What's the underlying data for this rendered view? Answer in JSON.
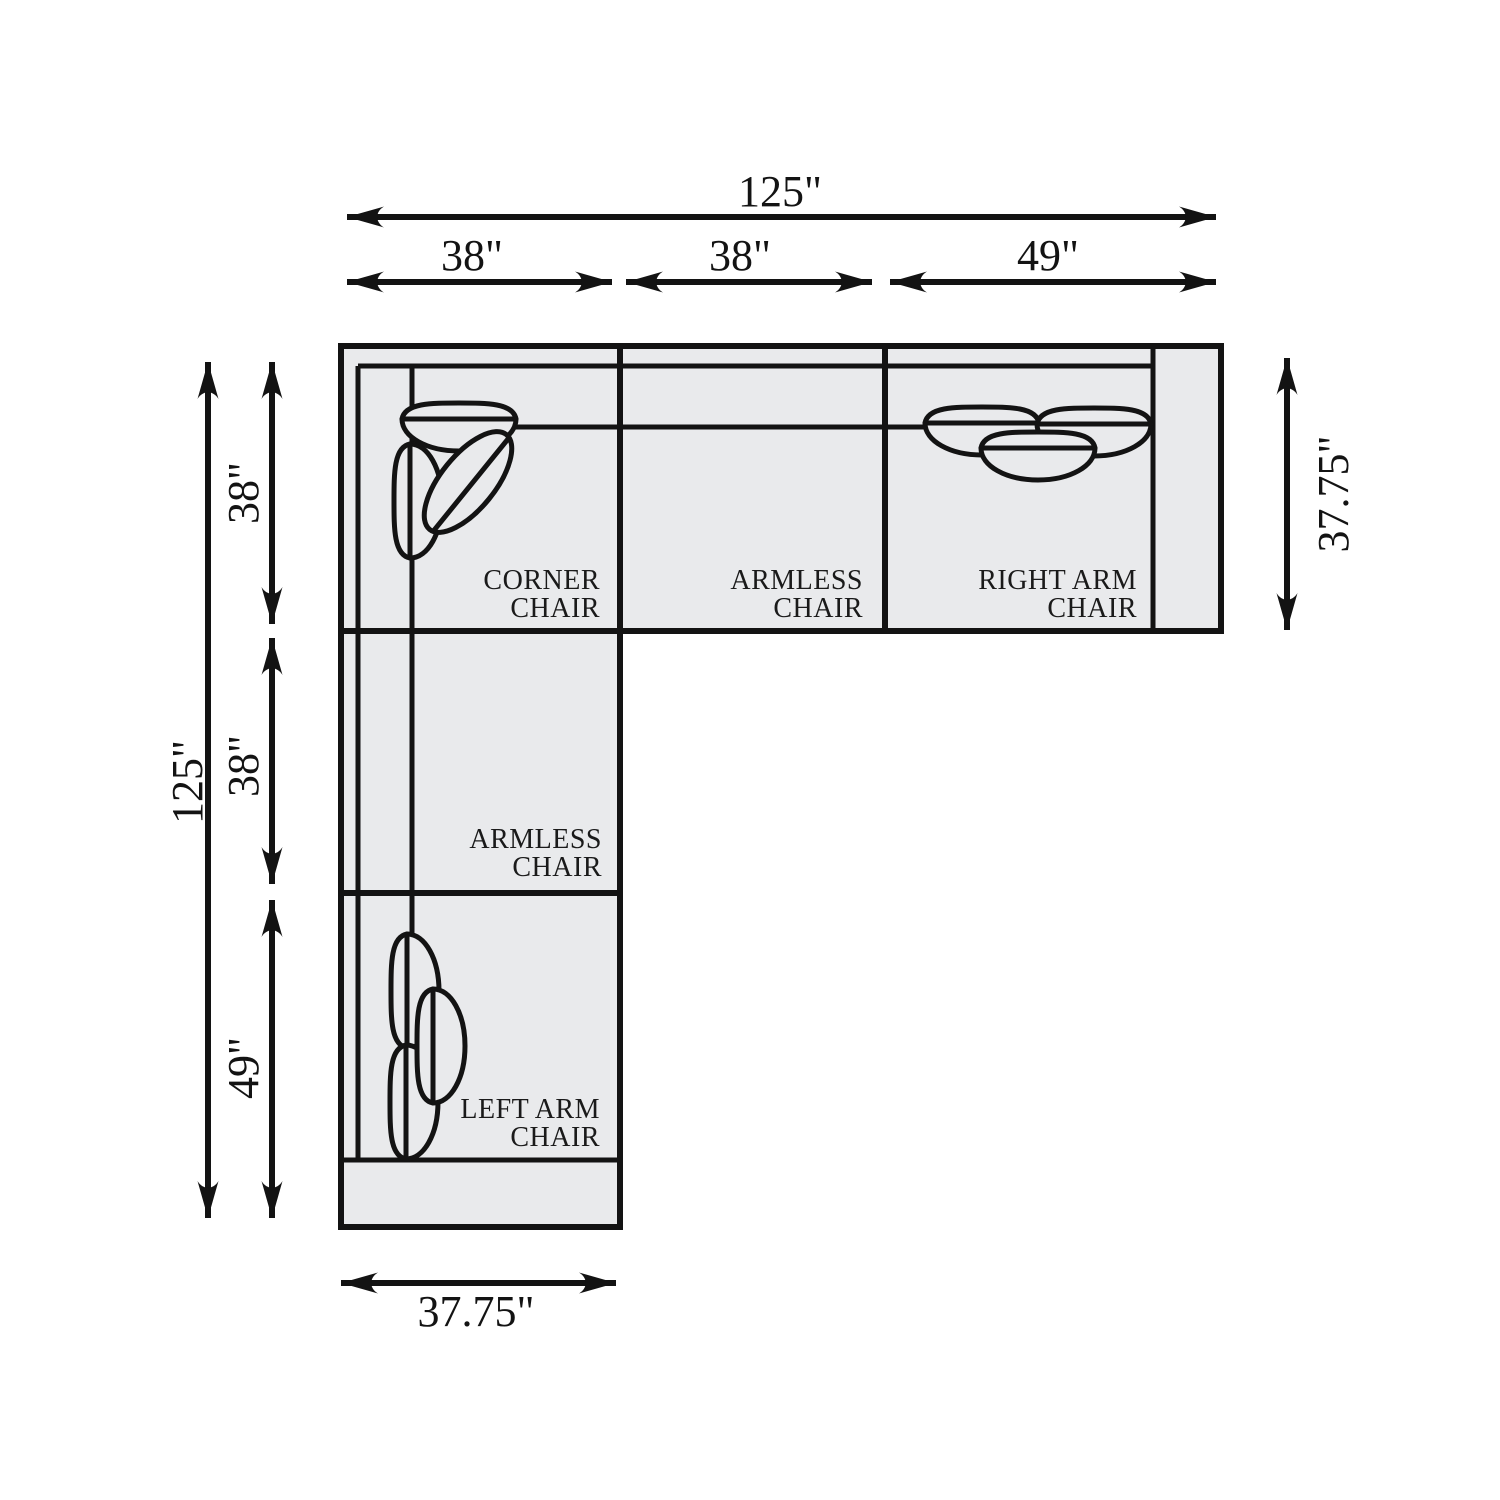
{
  "diagram_title": "sectional-sofa-floorplan",
  "colors": {
    "background": "#ffffff",
    "sofa_fill": "#e9eaec",
    "line": "#131313"
  },
  "sections": {
    "corner": {
      "line1": "CORNER",
      "line2": "CHAIR"
    },
    "armless_top": {
      "line1": "ARMLESS",
      "line2": "CHAIR"
    },
    "right_arm": {
      "line1": "RIGHT ARM",
      "line2": "CHAIR"
    },
    "armless_left": {
      "line1": "ARMLESS",
      "line2": "CHAIR"
    },
    "left_arm": {
      "line1": "LEFT ARM",
      "line2": "CHAIR"
    }
  },
  "dimensions": {
    "top_total": "125\"",
    "top_seg1": "38\"",
    "top_seg2": "38\"",
    "top_seg3": "49\"",
    "left_total": "125\"",
    "left_seg1": "38\"",
    "left_seg2": "38\"",
    "left_seg3": "49\"",
    "right_depth": "37.75\"",
    "bottom_depth": "37.75\""
  }
}
